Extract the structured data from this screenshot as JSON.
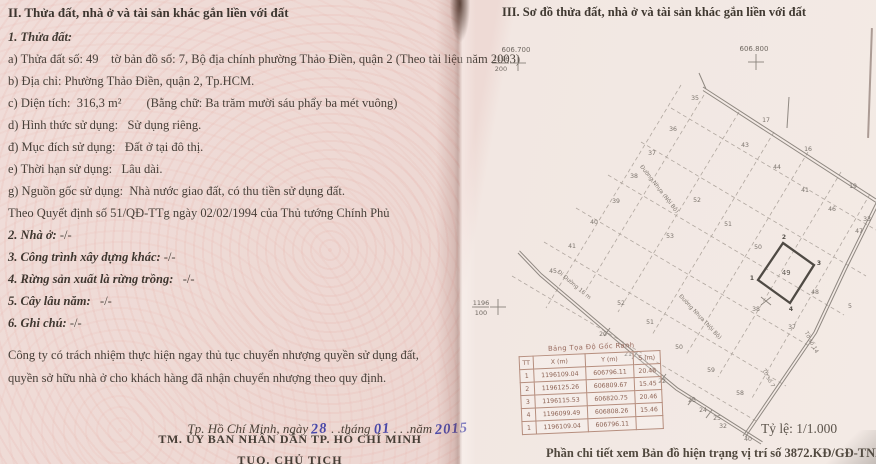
{
  "left_page": {
    "section_title": "II. Thửa đất, nhà ở và tài sản khác gắn liền với đất",
    "subsection_title": "1. Thửa đất:",
    "lines": [
      {
        "text": "a) Thửa đất số: 49    tờ bản đồ số: 7, Bộ địa chính phường Thảo Điền, quận 2 (Theo tài liệu năm 2003)"
      },
      {
        "text": "b) Địa chỉ: Phường Thảo Điền, quận 2, Tp.HCM."
      },
      {
        "text": "c) Diện tích:  316,3 m²        (Bằng chữ: Ba trăm mười sáu phẩy ba mét vuông)"
      },
      {
        "text": "d) Hình thức sử dụng:   Sử dụng riêng."
      },
      {
        "text": "đ) Mục đích sử dụng:   Đất ở tại đô thị."
      },
      {
        "text": "e) Thời hạn sử dụng:   Lâu dài."
      },
      {
        "text": "g) Nguồn gốc sử dụng:  Nhà nước giao đất, có thu tiền sử dụng đất."
      },
      {
        "text": "Theo Quyết định số 51/QĐ-TTg ngày 02/02/1994 của Thủ tướng Chính Phủ"
      },
      {
        "bold": "2. Nhà ở:",
        "text": " -/-"
      },
      {
        "bold": "3. Công trình xây dựng khác:",
        "text": " -/-"
      },
      {
        "bold": "4. Rừng sản xuất là rừng trồng:",
        "text": "   -/-"
      },
      {
        "bold": "5. Cây lâu năm:",
        "text": "   -/-"
      },
      {
        "bold": "6. Ghi chú:",
        "text": " -/-"
      }
    ],
    "note": "Công ty có trách nhiệm thực hiện ngay thủ tục chuyển nhượng quyền sử dụng đất, quyền sở hữu nhà ở cho khách hàng đã nhận chuyển nhượng theo quy định.",
    "date": {
      "prefix": "Tp. Hồ Chí Minh, ngày ",
      "day": "28",
      "mid1": " . .tháng ",
      "month": "01",
      "mid2": " . . .năm ",
      "year": "2015"
    },
    "signature_line1": "TM. ỦY BAN NHÂN DÂN TP. HỒ CHÍ MINH",
    "signature_line2": "TUQ. CHỦ TỊCH"
  },
  "map": {
    "section_title": "III. Sơ đồ thửa đất, nhà ở và tài sản khác gắn liền với đất",
    "scale_label": "Tỷ lệ: 1/1.000",
    "footer_note": "Phần chi tiết xem Bản đồ hiện trạng vị trí số 3872.KĐ/GĐ-TNMT",
    "grid_crosses": [
      {
        "x": 62,
        "y": 63,
        "label": "606.700",
        "frac_top": "1196",
        "frac_bottom": "200"
      },
      {
        "x": 300,
        "y": 62,
        "label": "606.800"
      },
      {
        "x": 42,
        "y": 307,
        "frac_top": "1196",
        "frac_bottom": "100"
      }
    ],
    "highlight_parcel": {
      "number": "49",
      "corners": [
        [
          327,
          243
        ],
        [
          358,
          265
        ],
        [
          334,
          303
        ],
        [
          302,
          280
        ]
      ],
      "corner_labels": [
        {
          "t": "2",
          "x": 328,
          "y": 239
        },
        {
          "t": "3",
          "x": 363,
          "y": 265
        },
        {
          "t": "4",
          "x": 335,
          "y": 311
        },
        {
          "t": "1",
          "x": 296,
          "y": 280
        }
      ]
    },
    "parcel_labels": [
      {
        "n": "35",
        "x": 239,
        "y": 100
      },
      {
        "n": "17",
        "x": 310,
        "y": 122
      },
      {
        "n": "36",
        "x": 217,
        "y": 131
      },
      {
        "n": "43",
        "x": 289,
        "y": 147
      },
      {
        "n": "16",
        "x": 352,
        "y": 151
      },
      {
        "n": "37",
        "x": 196,
        "y": 155
      },
      {
        "n": "44",
        "x": 321,
        "y": 169
      },
      {
        "n": "38",
        "x": 178,
        "y": 178
      },
      {
        "n": "19",
        "x": 397,
        "y": 188
      },
      {
        "n": "41",
        "x": 349,
        "y": 192
      },
      {
        "n": "52",
        "x": 241,
        "y": 202
      },
      {
        "n": "39",
        "x": 160,
        "y": 203
      },
      {
        "n": "46",
        "x": 376,
        "y": 211
      },
      {
        "n": "33",
        "x": 411,
        "y": 221
      },
      {
        "n": "40",
        "x": 138,
        "y": 224
      },
      {
        "n": "51",
        "x": 272,
        "y": 226
      },
      {
        "n": "47",
        "x": 403,
        "y": 233
      },
      {
        "n": "53",
        "x": 214,
        "y": 238
      },
      {
        "n": "41",
        "x": 116,
        "y": 248
      },
      {
        "n": "50",
        "x": 302,
        "y": 249
      },
      {
        "n": "45",
        "x": 97,
        "y": 273
      },
      {
        "n": "48",
        "x": 359,
        "y": 294
      },
      {
        "n": "52",
        "x": 165,
        "y": 305
      },
      {
        "n": "5",
        "x": 394,
        "y": 308
      },
      {
        "n": "38",
        "x": 300,
        "y": 311
      },
      {
        "n": "51",
        "x": 194,
        "y": 324
      },
      {
        "n": "37",
        "x": 336,
        "y": 329
      },
      {
        "n": "20",
        "x": 147,
        "y": 336
      },
      {
        "n": "50",
        "x": 223,
        "y": 349
      },
      {
        "n": "21",
        "x": 172,
        "y": 356
      },
      {
        "n": "59",
        "x": 255,
        "y": 372
      },
      {
        "n": "22",
        "x": 206,
        "y": 383
      },
      {
        "n": "58",
        "x": 284,
        "y": 395
      },
      {
        "n": "23",
        "x": 236,
        "y": 402
      },
      {
        "n": "24",
        "x": 247,
        "y": 412
      },
      {
        "n": "25",
        "x": 261,
        "y": 420
      },
      {
        "n": "32",
        "x": 267,
        "y": 428
      },
      {
        "n": "40",
        "x": 292,
        "y": 441
      }
    ],
    "road_labels": [
      {
        "text": "Đường Nhựa (Nội Bộ)",
        "x": 202,
        "y": 190,
        "angle": 52
      },
      {
        "text": "Đường Nhựa (Nội Bộ)",
        "x": 243,
        "y": 318,
        "angle": 47
      },
      {
        "text": "Đi Đường 16 m",
        "x": 117,
        "y": 286,
        "angle": 40
      },
      {
        "text": "Tờ số 7",
        "x": 311,
        "y": 379,
        "angle": 62
      },
      {
        "text": "Tờ số 14",
        "x": 354,
        "y": 343,
        "angle": 62
      }
    ],
    "coord_table": {
      "title": "Bảng Tọa Độ Gốc Ranh",
      "headers": [
        "TT",
        "X (m)",
        "Y (m)",
        "S (m)"
      ],
      "rows": [
        [
          "1",
          "1196109.04",
          "606796.11",
          "20.48"
        ],
        [
          "2",
          "1196125.26",
          "606809.67",
          "15.45"
        ],
        [
          "3",
          "1196115.53",
          "606820.75",
          "20.46"
        ],
        [
          "4",
          "1196099.49",
          "606808.26",
          "15.46"
        ],
        [
          "1",
          "1196109.04",
          "606796.11",
          ""
        ]
      ]
    }
  }
}
